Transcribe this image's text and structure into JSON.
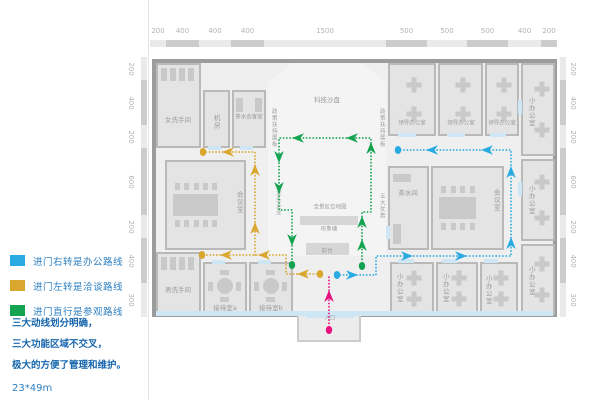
{
  "legend": {
    "items": [
      {
        "name": "office-route",
        "color": "#29abe2",
        "label": "进门右转是办公路线"
      },
      {
        "name": "talk-route",
        "color": "#d9a62e",
        "label": "进门左转是洽谈路线"
      },
      {
        "name": "visit-route",
        "color": "#14a351",
        "label": "进门直行是参观路线"
      }
    ]
  },
  "notes": {
    "lines": [
      "三大动线划分明确，",
      "三大功能区域不交叉，",
      "极大的方便了管理和维护。"
    ],
    "dimension": "23*49m"
  },
  "rulers": {
    "top": {
      "labels": [
        "200",
        "400",
        "400",
        "400",
        "1500",
        "500",
        "500",
        "500",
        "400",
        "200"
      ],
      "bounds": [
        150,
        166,
        199,
        231,
        264,
        386,
        427,
        467,
        508,
        541,
        557
      ],
      "strip_y": 40,
      "strip_h": 7,
      "label_y": 31
    },
    "left": {
      "labels": [
        "200",
        "400",
        "200",
        "600",
        "200",
        "400",
        "300"
      ],
      "bounds": [
        57,
        80,
        125,
        148,
        215,
        238,
        283,
        317
      ],
      "strip_x": 141,
      "strip_w": 6,
      "label_x": 131
    },
    "right": {
      "labels": [
        "200",
        "400",
        "200",
        "600",
        "200",
        "400",
        "300"
      ],
      "bounds": [
        57,
        80,
        125,
        148,
        215,
        238,
        283,
        317
      ],
      "strip_x": 560,
      "strip_w": 6,
      "label_x": 573
    }
  },
  "colors": {
    "wall": "#9c9c9c",
    "room_fill": "#e4e4e4",
    "room_border": "#b9b9b9",
    "corridor": "#efefef",
    "hall": "#f4f4f4",
    "furniture": "#c9c9c9",
    "door": "#cfe6f5",
    "label": "#9b9b9b",
    "ruler_light": "#eaeaea",
    "ruler_dark": "#cccccc",
    "facade": "#d9e6f0"
  },
  "plan": {
    "building": {
      "x": 152,
      "y": 59,
      "w": 405,
      "h": 258
    },
    "vestibule": {
      "x": 297,
      "y": 315,
      "w": 64,
      "h": 27
    },
    "facade_band": {
      "x": 156,
      "y": 311,
      "w": 397,
      "h": 5
    },
    "hall": {
      "x": 268,
      "y": 63,
      "w": 118,
      "h": 193,
      "chamfer": 24
    },
    "rooms": [
      {
        "name": "women-restroom",
        "label": "女洗手间",
        "x": 156,
        "y": 63,
        "w": 45,
        "h": 85,
        "lx": 178,
        "ly": 120,
        "furniture": "stalls"
      },
      {
        "name": "server-room",
        "label": "机房",
        "x": 203,
        "y": 90,
        "w": 27,
        "h": 58,
        "lx": 216,
        "ly": 122,
        "vertical": true
      },
      {
        "name": "tea-reception-room",
        "label": "茶水会客室",
        "x": 232,
        "y": 90,
        "w": 34,
        "h": 58,
        "lx": 249,
        "ly": 118,
        "tiny": true,
        "furniture": "sofas"
      },
      {
        "name": "leader-office-1",
        "label": "领导办公室",
        "x": 388,
        "y": 63,
        "w": 48,
        "h": 73,
        "lx": 412,
        "ly": 124,
        "tiny": true,
        "furniture": "desks"
      },
      {
        "name": "leader-office-2",
        "label": "领导办公室",
        "x": 438,
        "y": 63,
        "w": 45,
        "h": 73,
        "lx": 461,
        "ly": 124,
        "tiny": true,
        "furniture": "desks"
      },
      {
        "name": "leader-office-3",
        "label": "领导办公室",
        "x": 485,
        "y": 63,
        "w": 34,
        "h": 73,
        "lx": 502,
        "ly": 124,
        "tiny": true,
        "furniture": "desks"
      },
      {
        "name": "small-office-right-1",
        "label": "小办公室",
        "x": 521,
        "y": 63,
        "w": 34,
        "h": 93,
        "lx": 531,
        "ly": 112,
        "vertical": true,
        "furniture": "desks-v"
      },
      {
        "name": "small-office-right-2",
        "label": "小办公室",
        "x": 521,
        "y": 159,
        "w": 34,
        "h": 82,
        "lx": 531,
        "ly": 200,
        "vertical": true,
        "furniture": "desks-v"
      },
      {
        "name": "small-office-right-3",
        "label": "小办公室",
        "x": 521,
        "y": 244,
        "w": 34,
        "h": 71,
        "lx": 531,
        "ly": 281,
        "vertical": true,
        "furniture": "desks-v"
      },
      {
        "name": "tea-room",
        "label": "茶水间",
        "x": 388,
        "y": 166,
        "w": 41,
        "h": 84,
        "lx": 408,
        "ly": 193,
        "furniture": "counter"
      },
      {
        "name": "meeting-room-right",
        "label": "会议室",
        "x": 431,
        "y": 166,
        "w": 73,
        "h": 84,
        "lx": 496,
        "ly": 200,
        "vertical": true,
        "furniture": "conference"
      },
      {
        "name": "meeting-room-left",
        "label": "会议室",
        "x": 165,
        "y": 160,
        "w": 81,
        "h": 90,
        "lx": 239,
        "ly": 202,
        "vertical": true,
        "furniture": "conference"
      },
      {
        "name": "men-restroom",
        "label": "男洗手间",
        "x": 156,
        "y": 252,
        "w": 45,
        "h": 63,
        "lx": 178,
        "ly": 290,
        "furniture": "stalls"
      },
      {
        "name": "reception-room-a",
        "label": "接待室a",
        "x": 203,
        "y": 262,
        "w": 44,
        "h": 53,
        "lx": 225,
        "ly": 308,
        "furniture": "round-table"
      },
      {
        "name": "reception-room-b",
        "label": "接待室b",
        "x": 249,
        "y": 262,
        "w": 44,
        "h": 53,
        "lx": 271,
        "ly": 308,
        "furniture": "round-table"
      },
      {
        "name": "small-office-bottom-1",
        "label": "小办公室",
        "x": 390,
        "y": 262,
        "w": 44,
        "h": 53,
        "lx": 399,
        "ly": 288,
        "vertical": true,
        "furniture": "desks"
      },
      {
        "name": "small-office-bottom-2",
        "label": "小办公室",
        "x": 436,
        "y": 262,
        "w": 42,
        "h": 53,
        "lx": 445,
        "ly": 288,
        "vertical": true,
        "furniture": "desks"
      },
      {
        "name": "small-office-bottom-3",
        "label": "小办公室",
        "x": 480,
        "y": 262,
        "w": 38,
        "h": 53,
        "lx": 488,
        "ly": 290,
        "vertical": true,
        "furniture": "desks"
      }
    ],
    "labels": [
      {
        "name": "tech-sandtable-label",
        "text": "科技沙盘",
        "x": 327,
        "y": 100
      },
      {
        "name": "policy-wall-left-label",
        "text": "政策扶持展板",
        "x": 273,
        "y": 128,
        "vertical": true,
        "tiny": true
      },
      {
        "name": "policy-wall-right-label",
        "text": "政策扶持展板",
        "x": 381,
        "y": 128,
        "vertical": true,
        "tiny": true
      },
      {
        "name": "panorama-map-label",
        "text": "全景区位地图",
        "x": 330,
        "y": 208,
        "tiny": true
      },
      {
        "name": "image-wall-label",
        "text": "形象墙",
        "x": 329,
        "y": 230,
        "tiny": true
      },
      {
        "name": "front-desk-label",
        "text": "前台",
        "x": 327,
        "y": 252,
        "tiny": true
      },
      {
        "name": "leading-enterprise-label",
        "text": "龙头企业",
        "x": 277,
        "y": 203,
        "vertical": true,
        "tiny": true
      },
      {
        "name": "five-advantages-label",
        "text": "五大优势",
        "x": 381,
        "y": 206,
        "vertical": true,
        "tiny": true
      },
      {
        "name": "entrance-label",
        "text": "入口",
        "x": 330,
        "y": 319,
        "tiny": true
      }
    ],
    "bars": [
      {
        "name": "panorama-map-wall",
        "x": 300,
        "y": 216,
        "w": 58,
        "h": 9
      },
      {
        "name": "front-desk",
        "x": 306,
        "y": 243,
        "w": 43,
        "h": 12
      }
    ],
    "doors": [
      {
        "x": 306,
        "y": 312,
        "w": 48,
        "h": 6
      },
      {
        "x": 398,
        "y": 133,
        "w": 18,
        "h": 4
      },
      {
        "x": 447,
        "y": 133,
        "w": 18,
        "h": 4
      },
      {
        "x": 490,
        "y": 133,
        "w": 16,
        "h": 4
      },
      {
        "x": 398,
        "y": 259,
        "w": 16,
        "h": 4
      },
      {
        "x": 442,
        "y": 259,
        "w": 16,
        "h": 4
      },
      {
        "x": 484,
        "y": 259,
        "w": 14,
        "h": 4
      },
      {
        "x": 208,
        "y": 146,
        "w": 13,
        "h": 4
      },
      {
        "x": 240,
        "y": 146,
        "w": 13,
        "h": 4
      },
      {
        "x": 212,
        "y": 260,
        "w": 13,
        "h": 4
      },
      {
        "x": 258,
        "y": 260,
        "w": 13,
        "h": 4
      },
      {
        "x": 518,
        "y": 100,
        "w": 4,
        "h": 14
      },
      {
        "x": 518,
        "y": 182,
        "w": 4,
        "h": 14
      },
      {
        "x": 386,
        "y": 226,
        "w": 4,
        "h": 13
      }
    ],
    "routes": [
      {
        "name": "office-route",
        "color": "#29abe2",
        "lines": [
          [
            [
              337,
              275
            ],
            [
              376,
              275
            ],
            [
              376,
              256
            ],
            [
              511,
              256
            ],
            [
              511,
              150
            ],
            [
              398,
              150
            ]
          ]
        ],
        "arrows": [
          {
            "x": 352,
            "y": 275,
            "d": "right"
          },
          {
            "x": 407,
            "y": 256,
            "d": "right"
          },
          {
            "x": 461,
            "y": 256,
            "d": "right"
          },
          {
            "x": 511,
            "y": 243,
            "d": "up"
          },
          {
            "x": 511,
            "y": 172,
            "d": "up"
          },
          {
            "x": 487,
            "y": 150,
            "d": "left"
          },
          {
            "x": 432,
            "y": 150,
            "d": "left"
          }
        ],
        "dots": [
          [
            337,
            275
          ],
          [
            398,
            150
          ]
        ]
      },
      {
        "name": "talk-route",
        "color": "#d9a62e",
        "lines": [
          [
            [
              320,
              274
            ],
            [
              286,
              274
            ],
            [
              286,
              255
            ],
            [
              202,
              255
            ]
          ],
          [
            [
              255,
              255
            ],
            [
              255,
              152
            ],
            [
              203,
              152
            ]
          ]
        ],
        "arrows": [
          {
            "x": 303,
            "y": 274,
            "d": "left"
          },
          {
            "x": 264,
            "y": 255,
            "d": "left"
          },
          {
            "x": 226,
            "y": 255,
            "d": "left"
          },
          {
            "x": 255,
            "y": 228,
            "d": "up"
          },
          {
            "x": 255,
            "y": 170,
            "d": "up"
          },
          {
            "x": 228,
            "y": 152,
            "d": "left"
          }
        ],
        "dots": [
          [
            320,
            274
          ],
          [
            202,
            255
          ],
          [
            203,
            152
          ]
        ]
      },
      {
        "name": "visit-route",
        "color": "#14a351",
        "lines": [
          [
            [
              362,
              266
            ],
            [
              362,
              212
            ],
            [
              371,
              212
            ],
            [
              371,
              138
            ],
            [
              279,
              138
            ],
            [
              279,
              210
            ],
            [
              292,
              210
            ],
            [
              292,
              265
            ]
          ]
        ],
        "arrows": [
          {
            "x": 362,
            "y": 245,
            "d": "up"
          },
          {
            "x": 362,
            "y": 222,
            "d": "up"
          },
          {
            "x": 371,
            "y": 148,
            "d": "up"
          },
          {
            "x": 352,
            "y": 138,
            "d": "left"
          },
          {
            "x": 298,
            "y": 138,
            "d": "left"
          },
          {
            "x": 279,
            "y": 157,
            "d": "down"
          },
          {
            "x": 279,
            "y": 188,
            "d": "down"
          },
          {
            "x": 292,
            "y": 240,
            "d": "down"
          }
        ],
        "dots": [
          [
            362,
            266
          ],
          [
            292,
            265
          ]
        ]
      },
      {
        "name": "entrance-route",
        "color": "#e8117f",
        "lines": [
          [
            [
              329,
              330
            ],
            [
              329,
              277
            ]
          ]
        ],
        "arrows": [
          {
            "x": 329,
            "y": 296,
            "d": "up"
          }
        ],
        "dots": [
          [
            329,
            330
          ]
        ]
      }
    ]
  }
}
